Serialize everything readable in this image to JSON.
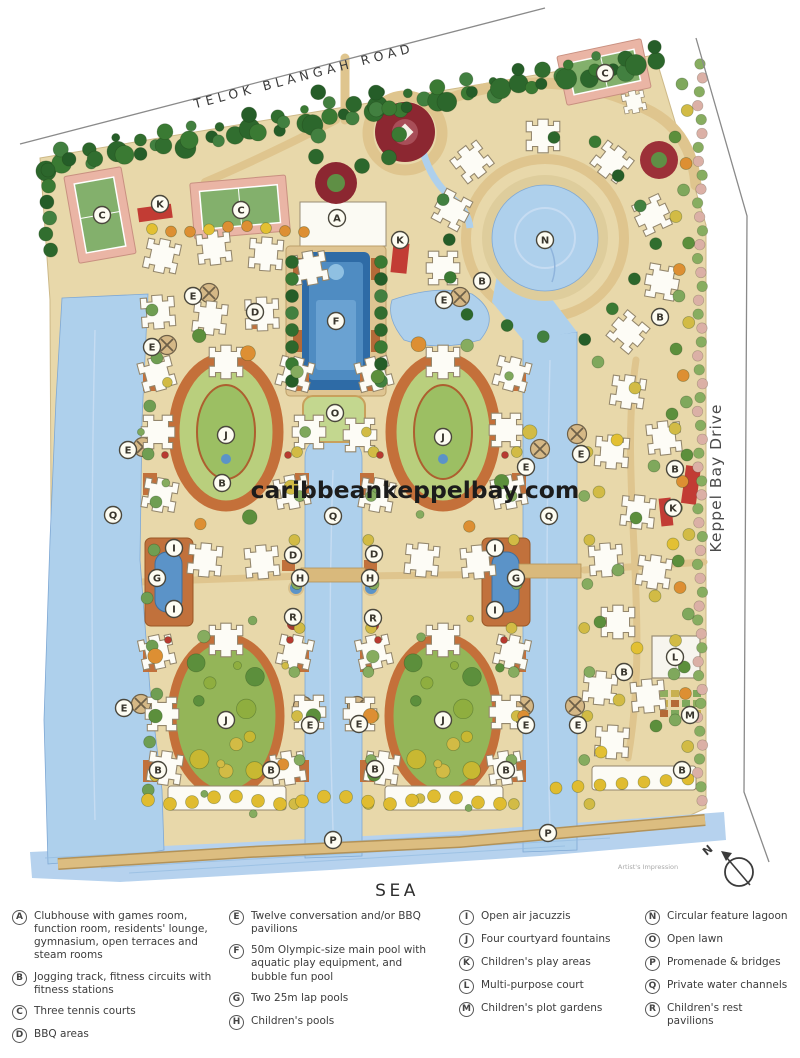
{
  "map": {
    "road_top": "TELOK BLANGAH ROAD",
    "road_right": "Keppel Bay Drive",
    "sea_label": "SEA",
    "watermark": "caribbeankeppelbay.com",
    "artist_note": "Artist's Impression",
    "compass_label": "N",
    "markers": [
      {
        "letter": "C",
        "x": 102,
        "y": 215
      },
      {
        "letter": "K",
        "x": 160,
        "y": 204
      },
      {
        "letter": "C",
        "x": 241,
        "y": 210
      },
      {
        "letter": "A",
        "x": 337,
        "y": 218
      },
      {
        "letter": "K",
        "x": 400,
        "y": 240
      },
      {
        "letter": "C",
        "x": 605,
        "y": 73
      },
      {
        "letter": "N",
        "x": 545,
        "y": 240
      },
      {
        "letter": "B",
        "x": 482,
        "y": 281
      },
      {
        "letter": "E",
        "x": 444,
        "y": 300
      },
      {
        "letter": "B",
        "x": 660,
        "y": 317
      },
      {
        "letter": "E",
        "x": 193,
        "y": 296
      },
      {
        "letter": "D",
        "x": 255,
        "y": 312
      },
      {
        "letter": "F",
        "x": 336,
        "y": 321
      },
      {
        "letter": "E",
        "x": 152,
        "y": 347
      },
      {
        "letter": "E",
        "x": 128,
        "y": 450
      },
      {
        "letter": "Q",
        "x": 113,
        "y": 515
      },
      {
        "letter": "J",
        "x": 226,
        "y": 435
      },
      {
        "letter": "B",
        "x": 222,
        "y": 483
      },
      {
        "letter": "O",
        "x": 335,
        "y": 413
      },
      {
        "letter": "Q",
        "x": 333,
        "y": 516
      },
      {
        "letter": "D",
        "x": 293,
        "y": 555
      },
      {
        "letter": "H",
        "x": 300,
        "y": 578
      },
      {
        "letter": "I",
        "x": 174,
        "y": 548
      },
      {
        "letter": "G",
        "x": 157,
        "y": 578
      },
      {
        "letter": "I",
        "x": 174,
        "y": 609
      },
      {
        "letter": "J",
        "x": 443,
        "y": 437
      },
      {
        "letter": "E",
        "x": 526,
        "y": 467
      },
      {
        "letter": "E",
        "x": 581,
        "y": 454
      },
      {
        "letter": "Q",
        "x": 549,
        "y": 516
      },
      {
        "letter": "B",
        "x": 675,
        "y": 469
      },
      {
        "letter": "K",
        "x": 673,
        "y": 508
      },
      {
        "letter": "I",
        "x": 495,
        "y": 548
      },
      {
        "letter": "G",
        "x": 516,
        "y": 578
      },
      {
        "letter": "I",
        "x": 495,
        "y": 610
      },
      {
        "letter": "D",
        "x": 374,
        "y": 554
      },
      {
        "letter": "H",
        "x": 370,
        "y": 578
      },
      {
        "letter": "R",
        "x": 293,
        "y": 617
      },
      {
        "letter": "R",
        "x": 373,
        "y": 618
      },
      {
        "letter": "E",
        "x": 124,
        "y": 708
      },
      {
        "letter": "J",
        "x": 226,
        "y": 720
      },
      {
        "letter": "E",
        "x": 310,
        "y": 725
      },
      {
        "letter": "E",
        "x": 359,
        "y": 724
      },
      {
        "letter": "J",
        "x": 443,
        "y": 720
      },
      {
        "letter": "E",
        "x": 526,
        "y": 725
      },
      {
        "letter": "E",
        "x": 578,
        "y": 725
      },
      {
        "letter": "B",
        "x": 158,
        "y": 770
      },
      {
        "letter": "B",
        "x": 271,
        "y": 770
      },
      {
        "letter": "B",
        "x": 375,
        "y": 769
      },
      {
        "letter": "B",
        "x": 506,
        "y": 770
      },
      {
        "letter": "B",
        "x": 624,
        "y": 672
      },
      {
        "letter": "L",
        "x": 675,
        "y": 657
      },
      {
        "letter": "M",
        "x": 690,
        "y": 715
      },
      {
        "letter": "B",
        "x": 682,
        "y": 770
      },
      {
        "letter": "P",
        "x": 333,
        "y": 840
      },
      {
        "letter": "P",
        "x": 548,
        "y": 833
      }
    ]
  },
  "legend": {
    "columns": [
      [
        {
          "key": "A",
          "label": "Clubhouse with games room, function room, residents' lounge, gymnasium, open terraces and steam rooms"
        },
        {
          "key": "B",
          "label": "Jogging track, fitness circuits with fitness stations"
        },
        {
          "key": "C",
          "label": "Three tennis courts"
        },
        {
          "key": "D",
          "label": "BBQ areas"
        }
      ],
      [
        {
          "key": "E",
          "label": "Twelve conversation and/or BBQ pavilions"
        },
        {
          "key": "F",
          "label": "50m Olympic-size main pool with aquatic play equipment, and bubble fun pool"
        },
        {
          "key": "G",
          "label": "Two 25m lap pools"
        },
        {
          "key": "H",
          "label": "Children's pools"
        }
      ],
      [
        {
          "key": "I",
          "label": "Open air jacuzzis"
        },
        {
          "key": "J",
          "label": "Four courtyard fountains"
        },
        {
          "key": "K",
          "label": "Children's play areas"
        },
        {
          "key": "L",
          "label": "Multi-purpose court"
        },
        {
          "key": "M",
          "label": "Children's plot gardens"
        }
      ],
      [
        {
          "key": "N",
          "label": "Circular feature lagoon"
        },
        {
          "key": "O",
          "label": "Open lawn"
        },
        {
          "key": "P",
          "label": "Promenade & bridges"
        },
        {
          "key": "Q",
          "label": "Private water channels"
        },
        {
          "key": "R",
          "label": "Children's rest pavilions"
        }
      ]
    ]
  },
  "colors": {
    "water": "#aed0ec",
    "site_tan": "#e8d8aa",
    "tree_green": "#3a7a33",
    "accent_red": "#8c2731",
    "court_pink": "#eab5a5",
    "terracotta": "#c1713c"
  }
}
